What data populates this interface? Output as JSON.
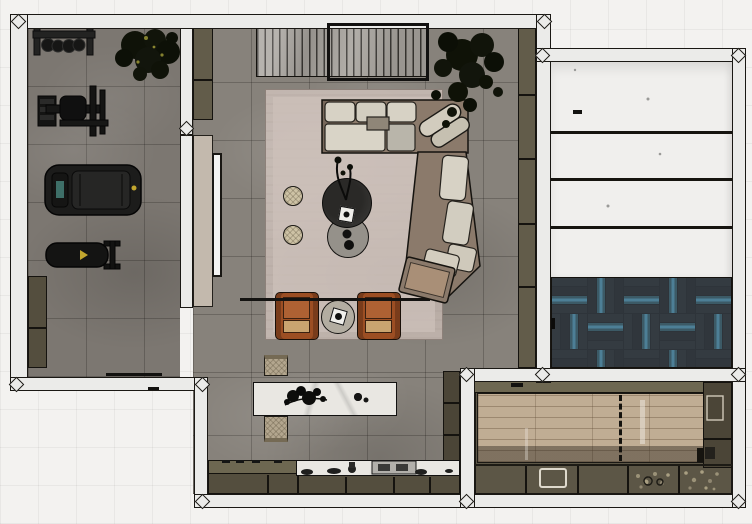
{
  "title": "top-down-interior-floor-plan",
  "palette": {
    "exterior": "#f3f2f0",
    "wall": "#ebebe9",
    "outline": "#15130f",
    "gym_floor": "#7c7771",
    "living_floor": "#87827b",
    "panel_room": "#f0efed",
    "rug": "#c1b5ae",
    "rug_inner": "#ccc0b9",
    "olive": "#625c4a",
    "olive_dark": "#544e3e",
    "olive_deep": "#4b4537",
    "olive_light": "#6d6751",
    "door_beige": "#c3b9ad",
    "mirror": "#f4f4f2",
    "slat_unit": "#a6a29c",
    "sofa_frame": "#8b7a6b",
    "cushion": "#d7d2c5",
    "cushion_gray": "#b9b5aa",
    "rust": "#9c4e23",
    "rust_light": "#ae6133",
    "weave": "#c9a470",
    "table_dark": "#2a2927",
    "table_gray": "#95918a",
    "side_table": "#b3ada1",
    "pouf": "#cdc2a5",
    "marble": "#e9e7e2",
    "bench_leather": "#b3a68e",
    "wood": "#c0ad94",
    "cabinet_room": "#5c5646",
    "herring_base": "#2e343a",
    "herring_teal": "#3c5a66",
    "herring_blue": "#4d7f96",
    "plant": "#12150d",
    "accent_yellow": "#c2a62e",
    "treadmill_black": "#1d1d1c"
  },
  "rooms": [
    {
      "id": "gym",
      "name": "home-gym"
    },
    {
      "id": "living",
      "name": "living-room"
    },
    {
      "id": "kitchen",
      "name": "kitchen"
    },
    {
      "id": "panel-room",
      "name": "white-paneled-room"
    },
    {
      "id": "carpet-room",
      "name": "blue-herringbone-room"
    },
    {
      "id": "cabinet-room",
      "name": "cabinet-room-wood-floor"
    }
  ],
  "furniture": [
    "weight-rack",
    "potted-plant",
    "cable-machine",
    "treadmill",
    "workout-bench",
    "storage-cabinet",
    "media-console",
    "tall-plant",
    "wall-shelf",
    "area-rug",
    "sectional-sofa",
    "lounge-chair",
    "ottoman",
    "coffee-table-dark",
    "coffee-table-gray",
    "pouf",
    "armchair",
    "side-table",
    "kitchen-island",
    "island-bench",
    "kitchen-counter",
    "tall-cabinet",
    "wood-floor-panel",
    "wall-mirror",
    "sliding-door"
  ]
}
